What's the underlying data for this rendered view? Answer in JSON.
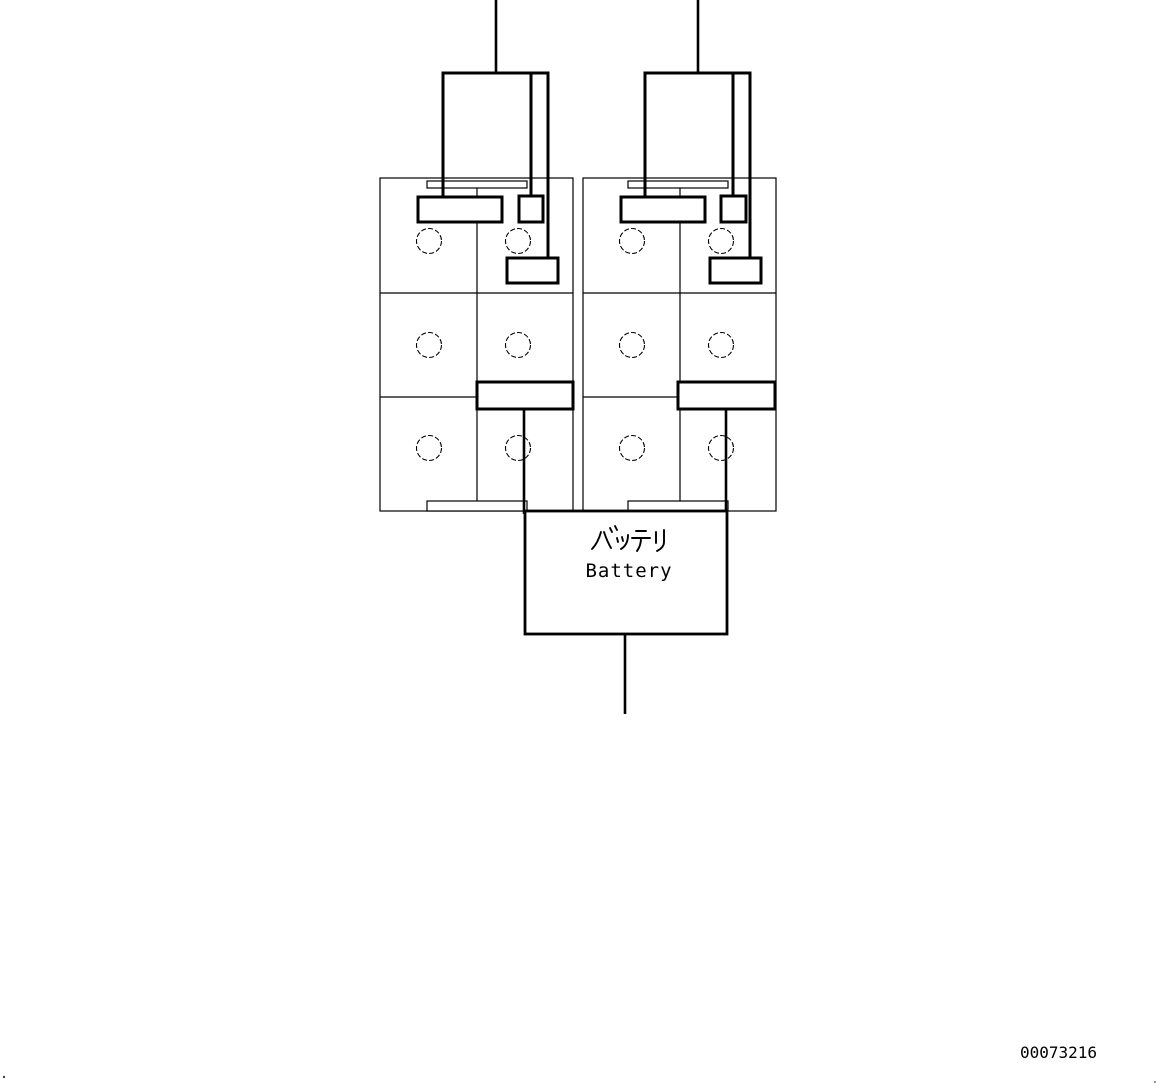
{
  "diagram": {
    "type": "parts-wiring-diagram",
    "background_color": "#ffffff",
    "line_color": "#000000",
    "label_box": {
      "title_japanese": "バッテリ",
      "title_english": "Battery"
    },
    "part_number": "00073216",
    "units": [
      {
        "id": "battery-unit-left",
        "cell_caps": 6,
        "rows": 3,
        "columns": 2
      },
      {
        "id": "battery-unit-right",
        "cell_caps": 6,
        "rows": 3,
        "columns": 2
      }
    ]
  }
}
